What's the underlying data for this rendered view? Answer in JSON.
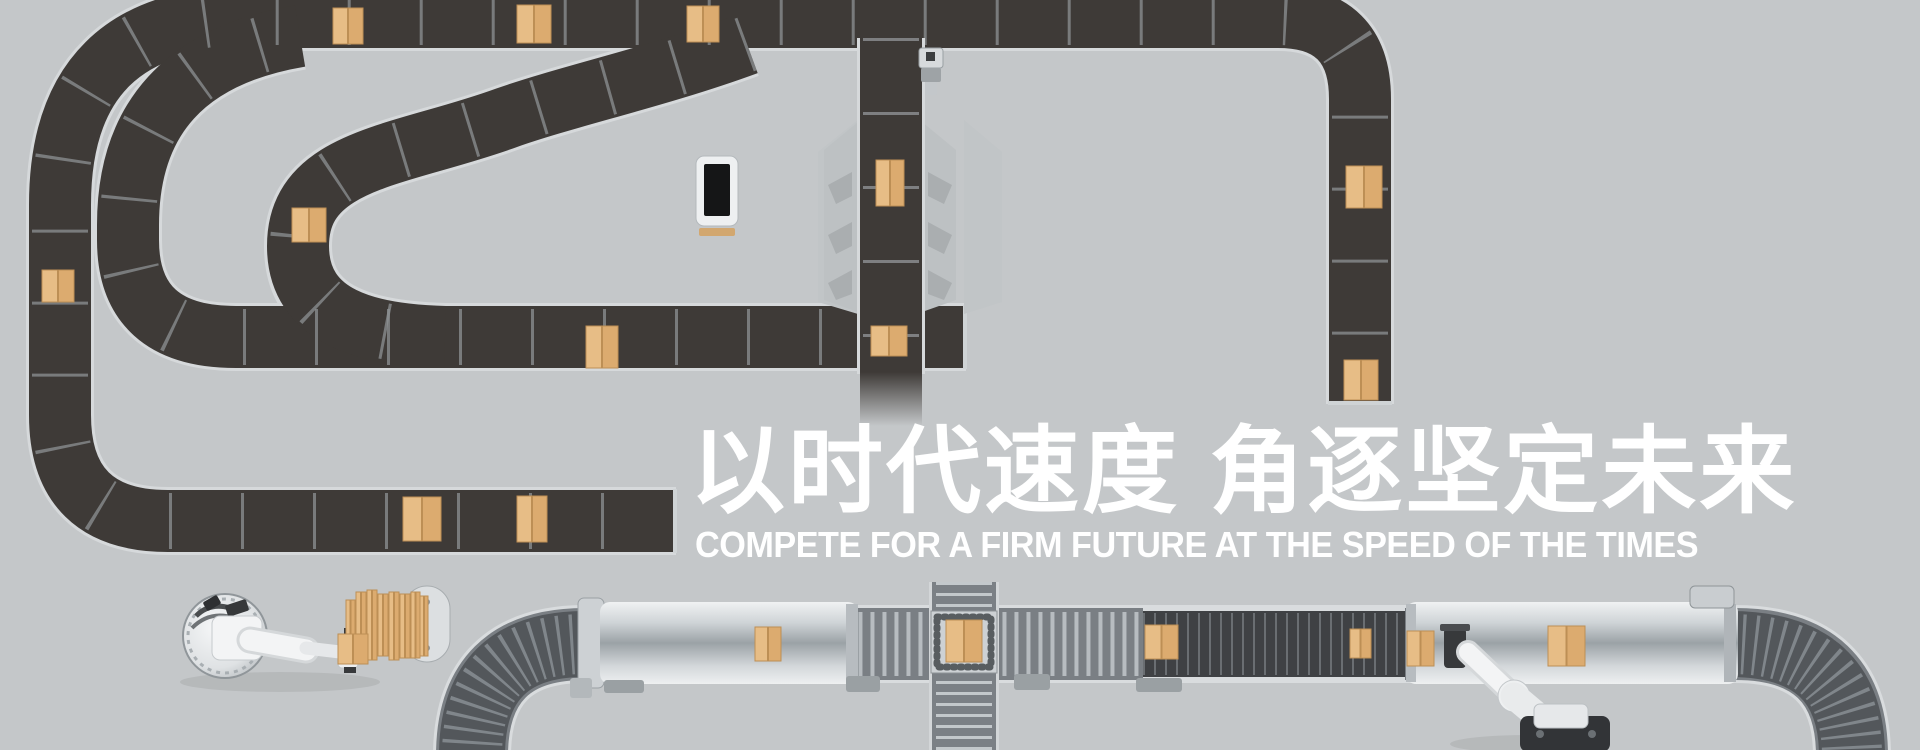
{
  "banner": {
    "headline_zh": "以时代速度 角逐坚定未来",
    "headline_en": "COMPETE FOR A FIRM FUTURE AT THE SPEED OF THE TIMES"
  },
  "colors": {
    "bg": "#c4c7c9",
    "belt": "#3e3a37",
    "belt_rail": "#d6d9db",
    "belt_tick": "#8e9194",
    "metal_base": "#7a7f84",
    "metal_rib": "#b7bcc0",
    "metal_dark": "#53575b",
    "metal_dark_rib": "#80868b",
    "panel": "#bdc1c3",
    "panel_notch": "#aaaeb0",
    "box_light": "#e7bd86",
    "box_mid": "#dcab6f",
    "box_dark": "#bd8f55",
    "robot_white": "#f3f4f5",
    "robot_shade": "#d7dadc",
    "robot_dark": "#37393b",
    "text": "#ffffff"
  },
  "boxes": {
    "dark_belts": [
      [
        333,
        8,
        30,
        36
      ],
      [
        517,
        5,
        34,
        38
      ],
      [
        687,
        6,
        32,
        36
      ],
      [
        1346,
        166,
        36,
        42
      ],
      [
        1344,
        360,
        34,
        40
      ],
      [
        42,
        270,
        32,
        32
      ],
      [
        292,
        208,
        34,
        34
      ],
      [
        586,
        326,
        32,
        42
      ],
      [
        871,
        326,
        36,
        30
      ],
      [
        876,
        160,
        28,
        46
      ],
      [
        403,
        497,
        38,
        44
      ],
      [
        517,
        496,
        30,
        46
      ]
    ],
    "metal_line": [
      [
        755,
        627,
        26,
        34
      ],
      [
        946,
        620,
        36,
        42
      ],
      [
        1145,
        625,
        33,
        34
      ],
      [
        1350,
        629,
        21,
        29
      ],
      [
        1407,
        631,
        27,
        35
      ],
      [
        1548,
        626,
        37,
        40
      ]
    ],
    "pallet_stack": [
      [
        356,
        592,
        10,
        66
      ],
      [
        367,
        590,
        10,
        70
      ],
      [
        378,
        594,
        10,
        62
      ],
      [
        389,
        592,
        10,
        68
      ],
      [
        400,
        594,
        10,
        64
      ],
      [
        411,
        592,
        9,
        66
      ],
      [
        420,
        596,
        8,
        60
      ],
      [
        346,
        600,
        9,
        54
      ],
      [
        338,
        634,
        30,
        30
      ]
    ]
  }
}
